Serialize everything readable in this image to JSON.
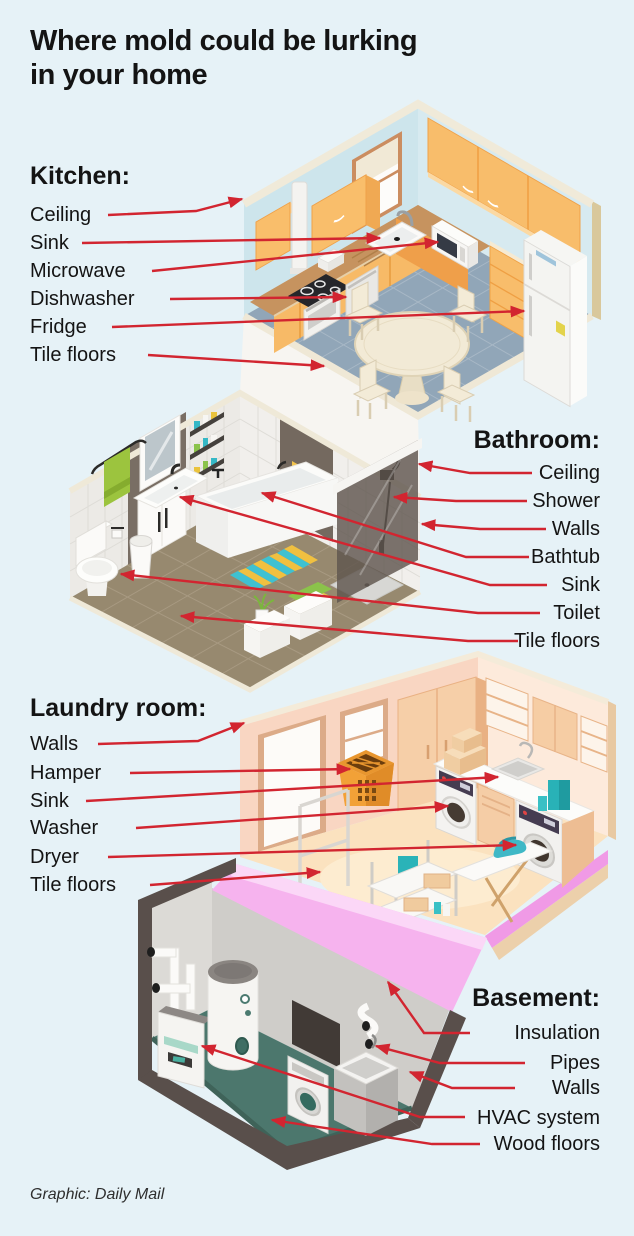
{
  "title": {
    "line1": "Where mold could be lurking",
    "line2": "in your home"
  },
  "sections": {
    "kitchen": {
      "heading": "Kitchen:",
      "labels": [
        "Ceiling",
        "Sink",
        "Microwave",
        "Dishwasher",
        "Fridge",
        "Tile floors"
      ]
    },
    "bathroom": {
      "heading": "Bathroom:",
      "labels": [
        "Ceiling",
        "Shower",
        "Walls",
        "Bathtub",
        "Sink",
        "Toilet",
        "Tile floors"
      ]
    },
    "laundry": {
      "heading": "Laundry room:",
      "labels": [
        "Walls",
        "Hamper",
        "Sink",
        "Washer",
        "Dryer",
        "Tile floors"
      ]
    },
    "basement": {
      "heading": "Basement:",
      "labels": [
        "Insulation",
        "Pipes",
        "Walls",
        "HVAC system",
        "Wood floors"
      ]
    }
  },
  "footer": {
    "credit": "Graphic: Daily Mail"
  },
  "colors": {
    "background": "#e6f2f7",
    "arrow": "#d22530",
    "text": "#141414"
  }
}
